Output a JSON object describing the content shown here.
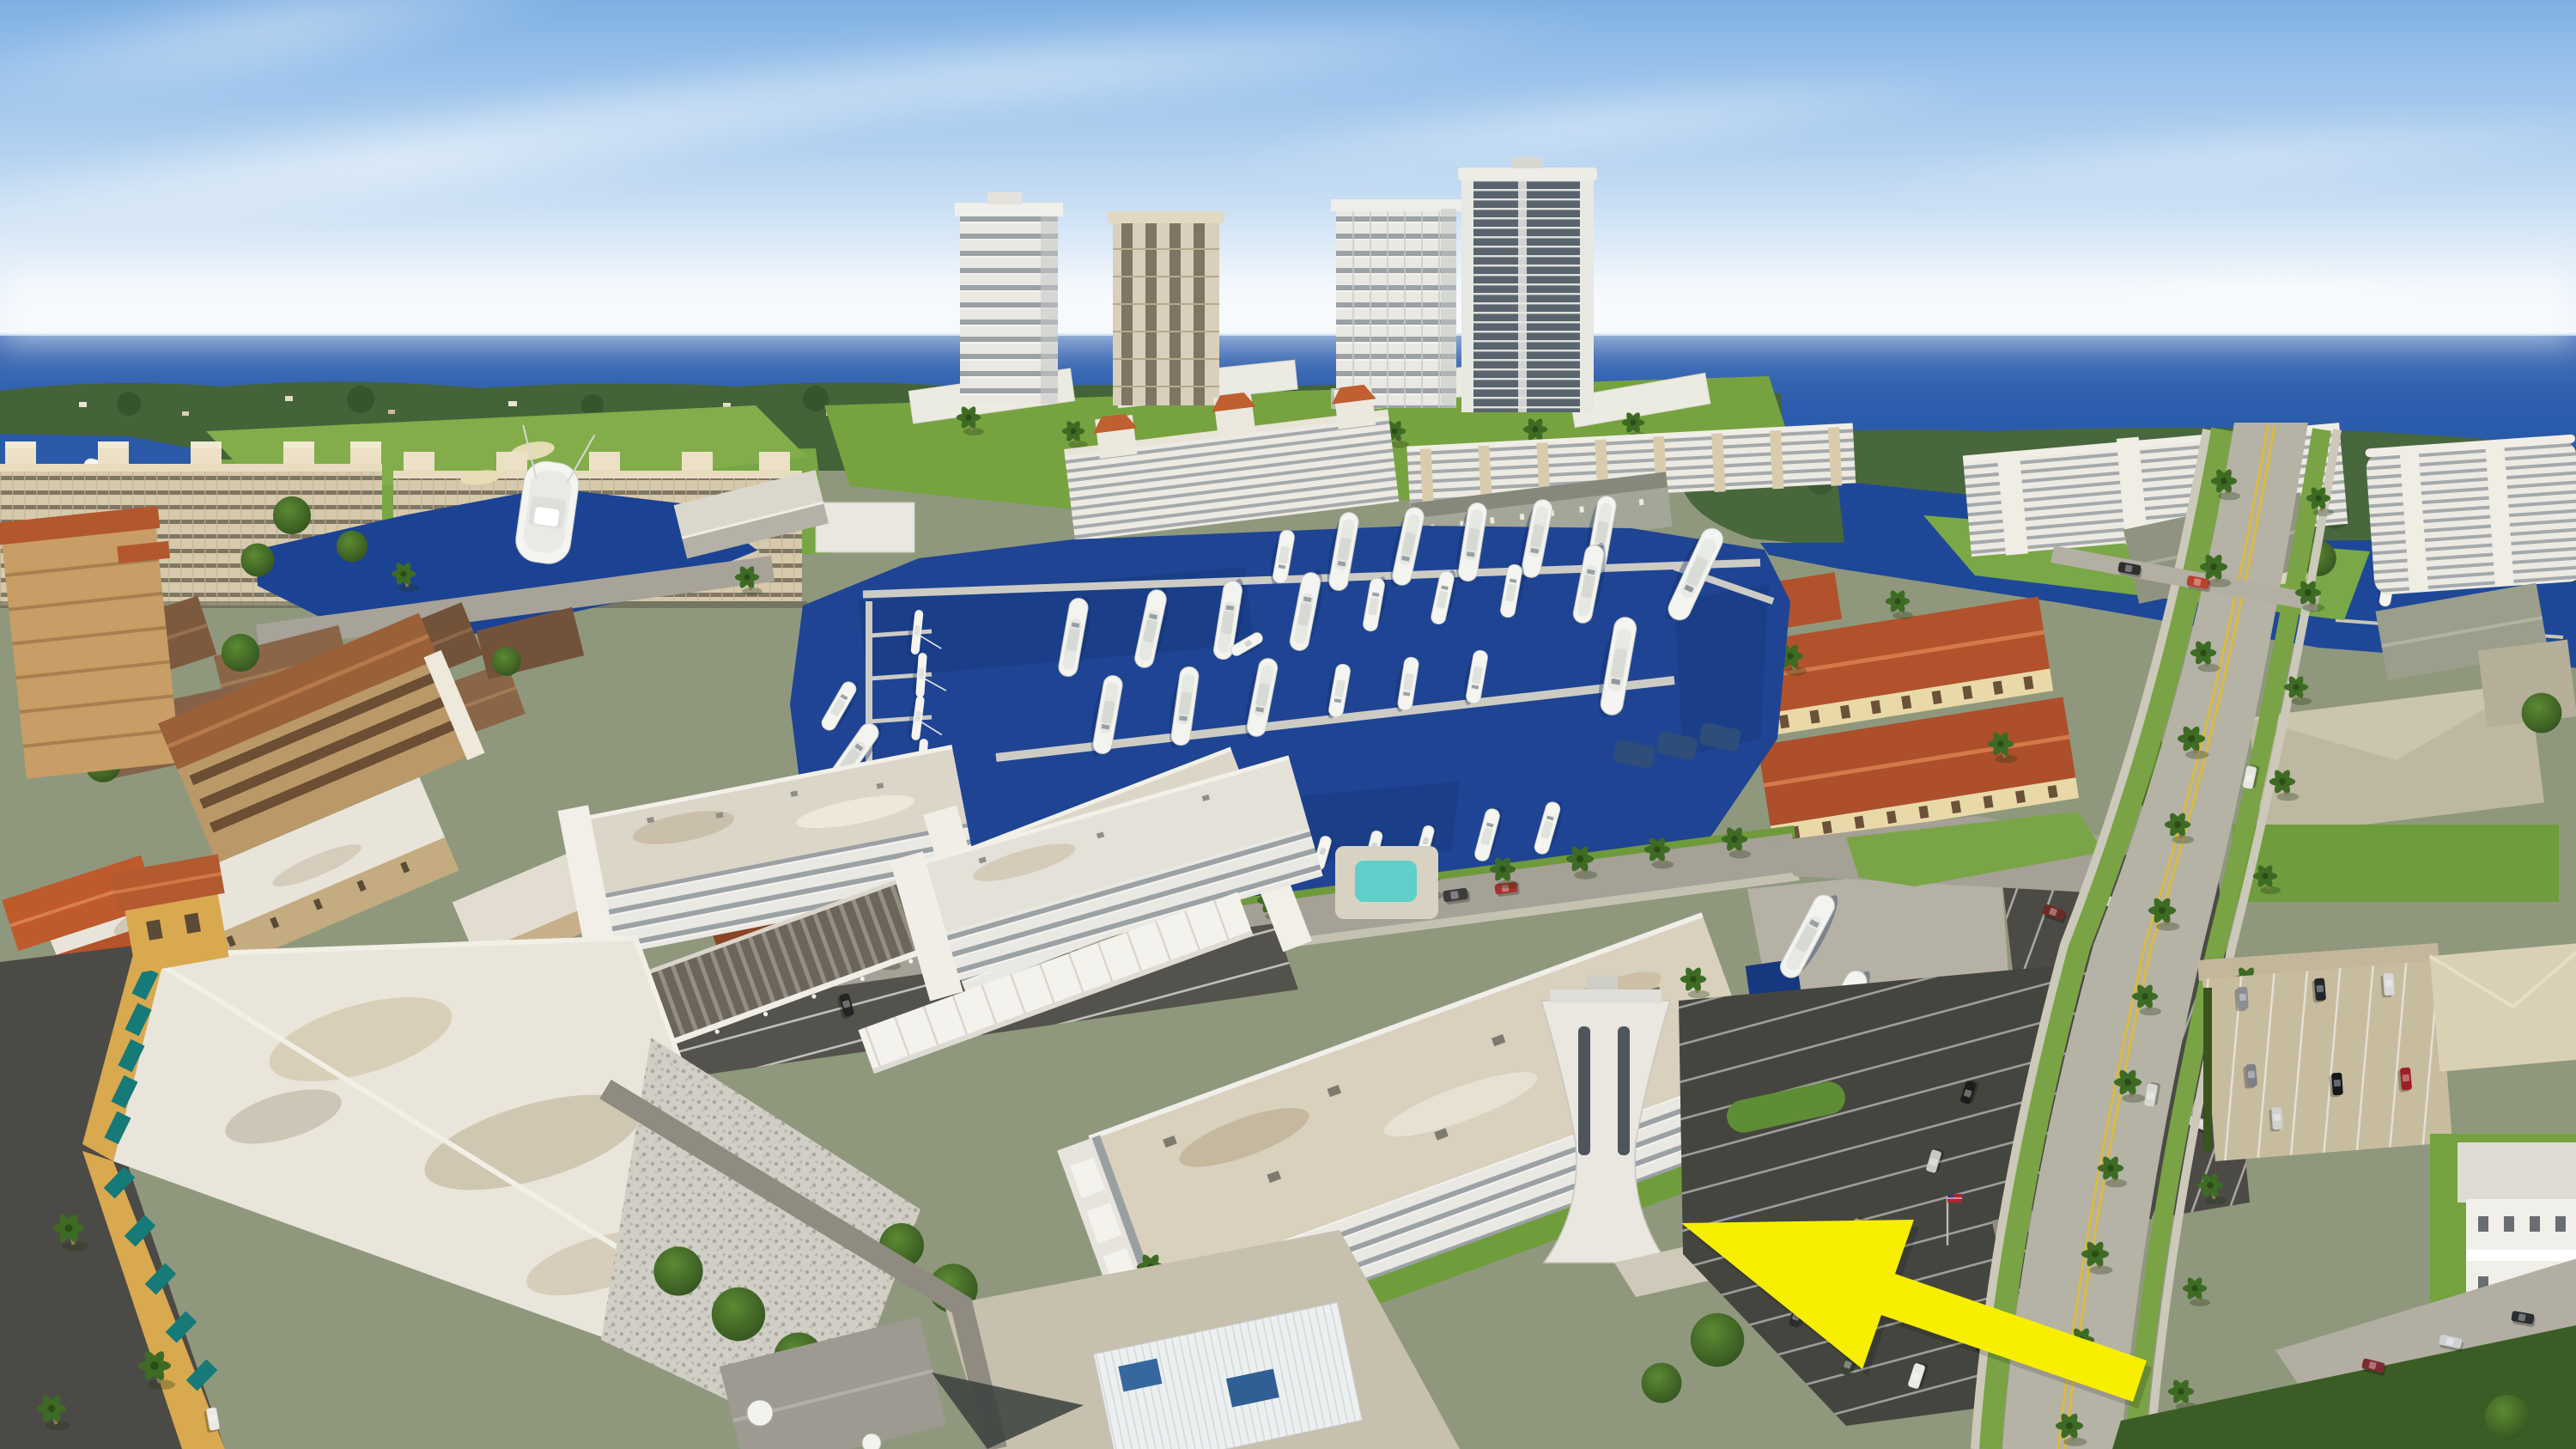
{
  "meta": {
    "title": "Oblique aerial drone photograph of a waterfront condominium community with marina",
    "media": "photograph",
    "view": "aerial oblique, looking toward the ocean"
  },
  "annotation": {
    "name": "highlight-arrow",
    "shape": "arrow",
    "color": "#F7EE00",
    "points_to": "white four-story condominium with flared entry tower",
    "tip_xy": [
      1958,
      1424
    ],
    "tail_xy": [
      2492,
      1608
    ]
  },
  "scene": {
    "sky": {
      "top_color": "#7FB0E2",
      "horizon_color": "#F2F7FC",
      "clouds": "thin cirrus streaks"
    },
    "ocean": {
      "color": "#1E4D9F"
    },
    "island": {
      "color": "#48673C",
      "label": "mangrove island"
    },
    "far_shore": {
      "color": "#446338",
      "label": "tree-lined far shore with scattered houses"
    },
    "marina": {
      "water_color": "#1F4493",
      "dock_color": "#CCCCC4",
      "boat_color": "#F3F4F0",
      "boats_approx": 40
    },
    "vegetation": {
      "lawn_color": "#76A340",
      "tree_color": "#3E6B24",
      "palms_approx": 55
    },
    "pools": {
      "color": "#5ED0C9",
      "count": 2
    },
    "roads": {
      "main_road_color": "#B5B2A6",
      "centerline_color": "#D9BB3E",
      "asphalt_color": "#4B4A45"
    },
    "landmarks": [
      {
        "id": "beige-highrise-slabs",
        "label": "beige high-rise condo slabs",
        "color": "#D6C9AC"
      },
      {
        "id": "highrise-towers",
        "label": "four waterfront high-rise towers",
        "color": "#E9E8E2"
      },
      {
        "id": "marina-basin",
        "label": "yacht marina basin"
      },
      {
        "id": "north-condo-row",
        "label": "low-rise condos with orange roof turrets",
        "color": "#EFECE3"
      },
      {
        "id": "spanish-complex",
        "label": "red-tile Spanish style complex",
        "color": "#B2522C"
      },
      {
        "id": "right-waterfront-condos",
        "label": "white waterfront condo slabs"
      },
      {
        "id": "subject-condo",
        "label": "white condo with flared tower (arrow target)",
        "color": "#E9E7E0",
        "arrow_target": true
      },
      {
        "id": "long-white-condo",
        "label": "long white condo with stained carport"
      },
      {
        "id": "carport",
        "label": "carport canopy",
        "color": "#6E675D"
      },
      {
        "id": "yellow-hotel",
        "label": "yellow hotel with teal awnings",
        "color": "#D9A94F",
        "awning_color": "#157A78"
      },
      {
        "id": "stone-wall",
        "label": "pebble stone end wall"
      },
      {
        "id": "dry-storage",
        "label": "boat dry-storage yard"
      },
      {
        "id": "colonial-house",
        "label": "white two-story house"
      },
      {
        "id": "canal",
        "label": "canal with sportfish yacht"
      },
      {
        "id": "boathouse",
        "label": "boathouse with ridged roof"
      }
    ],
    "vehicles": {
      "cars_approx": 30,
      "includes": [
        "van",
        "pickup",
        "white work van"
      ],
      "us_flag": true
    }
  },
  "palette": {
    "arrow_yellow": "#F7EE00",
    "ocean_blue": "#1E4D9F",
    "marina_blue": "#1F4493",
    "lawn_green": "#76A340",
    "tile_red": "#B2522C",
    "roof_brown": "#9A6038",
    "hotel_yellow": "#D9A94F",
    "awning_teal": "#157A78",
    "pool_teal": "#5ED0C9",
    "dock_gray": "#CCCCC4"
  }
}
